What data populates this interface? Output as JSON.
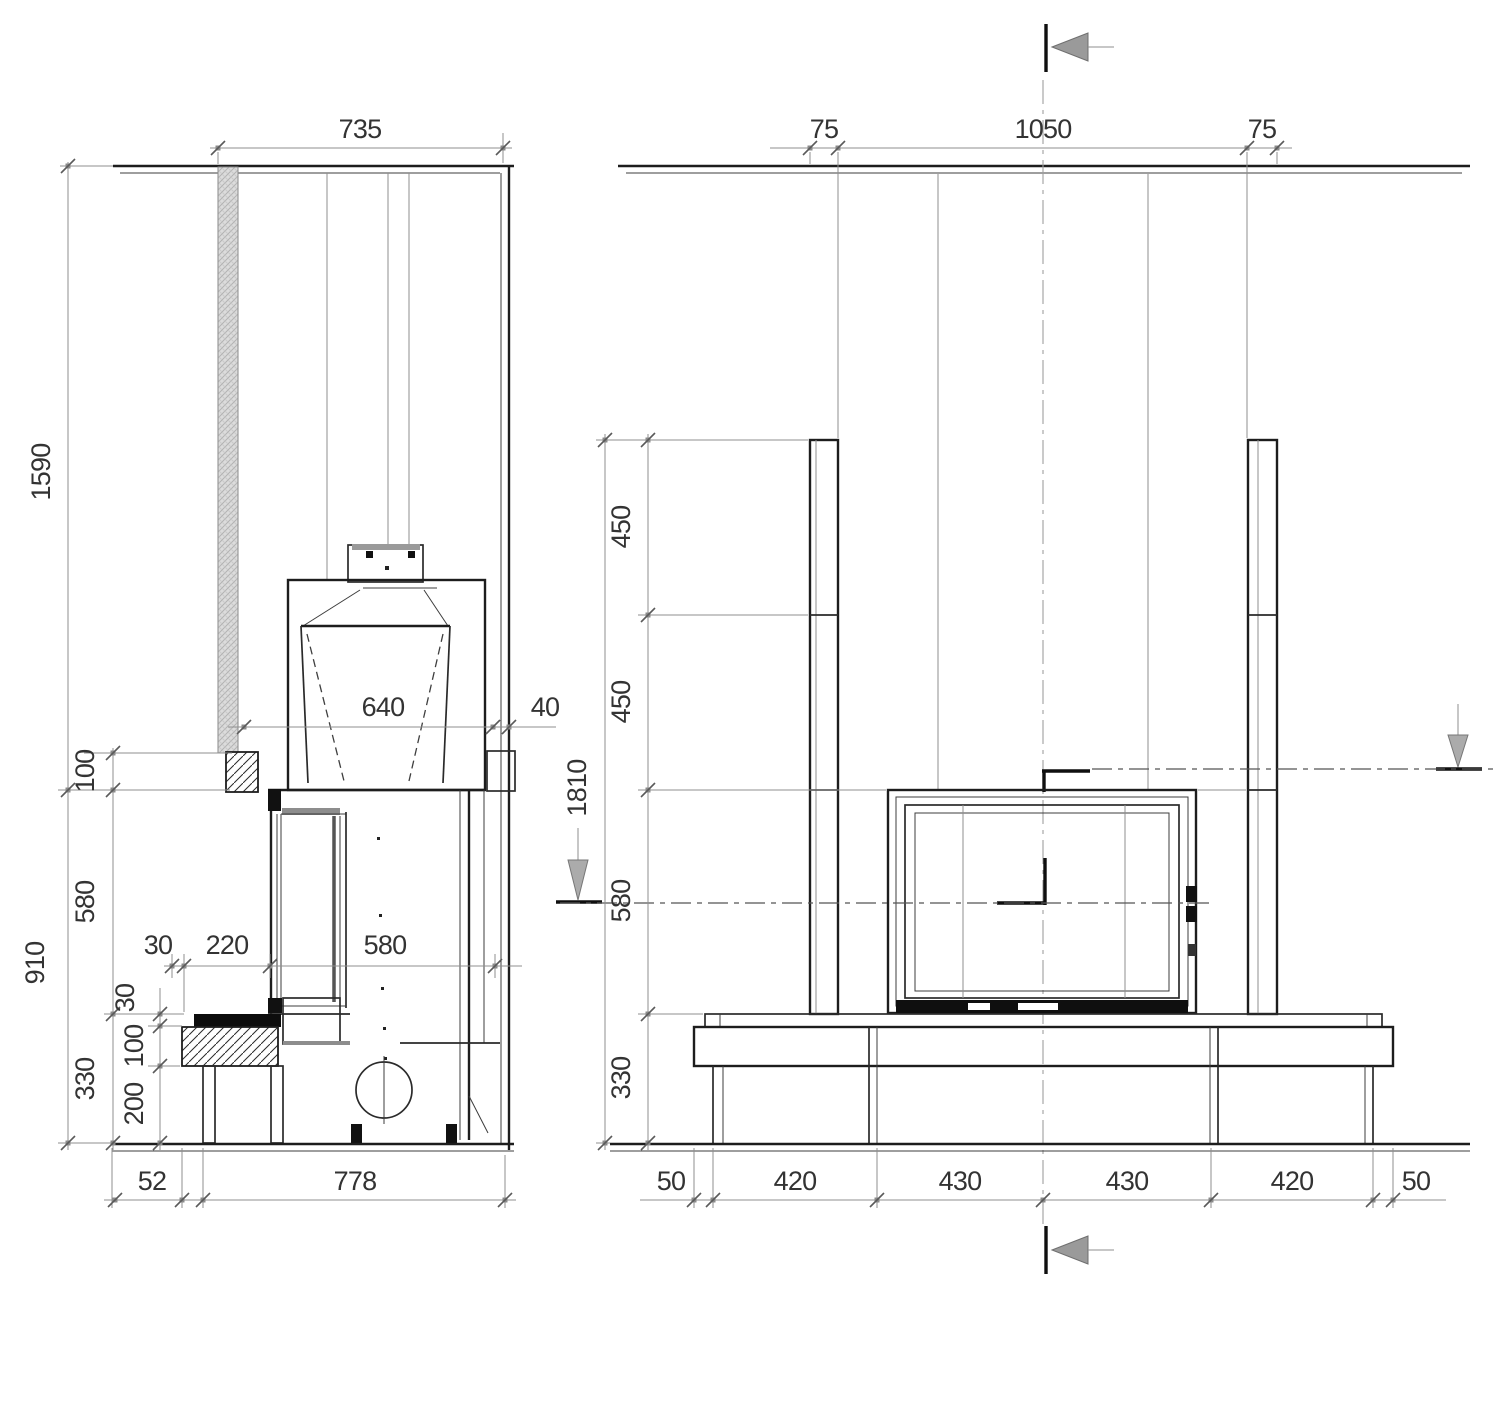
{
  "drawing": {
    "kind": "fireplace installation dimension drawing",
    "units": "mm",
    "line_color": "#1d1d1d",
    "dim_color": "#8f8f8f",
    "hatch_wall_color": "#d9d9d9"
  },
  "side_view": {
    "dims": {
      "top_width": "735",
      "wall_height": "1590",
      "connector_height": "100",
      "dome_width": "640",
      "rear_gap": "40",
      "mid_height": "580",
      "lower_total_height": "910",
      "base_total_height": "330",
      "front_gap": "30",
      "bench_depth": "220",
      "firebox_depth": "580",
      "bench_top_thickness": "30",
      "bench_block_height": "100",
      "leg_height": "200",
      "floor_offset": "52",
      "total_depth": "778"
    }
  },
  "front_view": {
    "dims": {
      "margin_left": "75",
      "opening_width": "1050",
      "margin_right": "75",
      "column_segment_upper": "450",
      "column_segment_lower": "450",
      "total_height": "1810",
      "firebox_height": "580",
      "base_height": "330",
      "floor_left": "50",
      "bench_segment_1": "420",
      "bench_segment_2": "430",
      "bench_segment_3": "430",
      "bench_segment_4": "420",
      "floor_right": "50"
    }
  }
}
